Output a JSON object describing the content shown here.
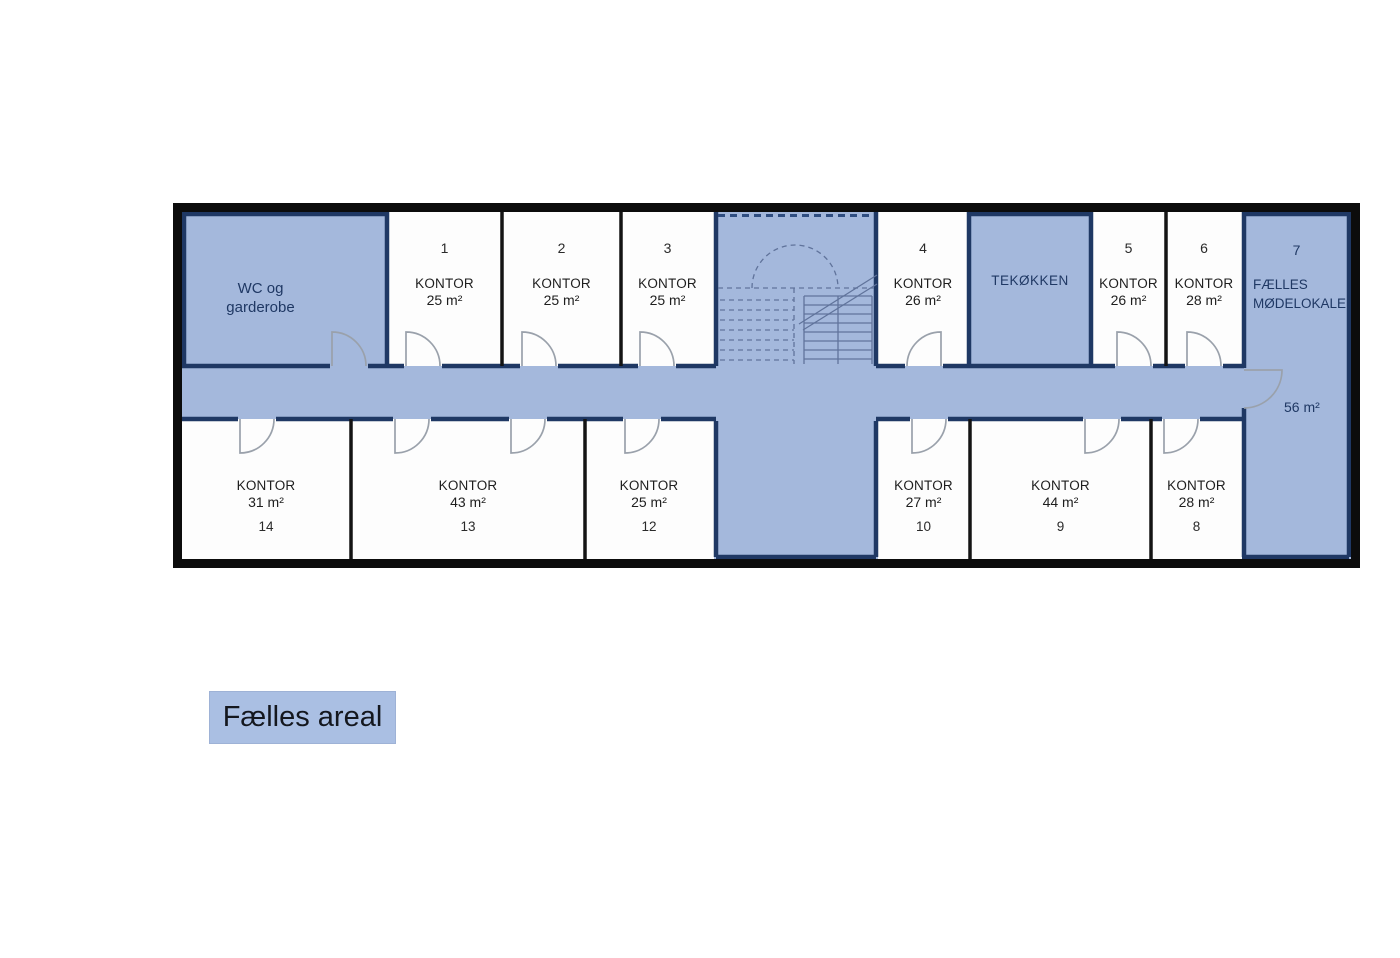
{
  "plan": {
    "rooms": {
      "wc": {
        "line1": "WC og",
        "line2": "garderobe"
      },
      "o1": {
        "num": "1",
        "label": "KONTOR",
        "area": "25 m²"
      },
      "o2": {
        "num": "2",
        "label": "KONTOR",
        "area": "25 m²"
      },
      "o3": {
        "num": "3",
        "label": "KONTOR",
        "area": "25 m²"
      },
      "o4": {
        "num": "4",
        "label": "KONTOR",
        "area": "26 m²"
      },
      "tek": {
        "label": "TEKØKKEN"
      },
      "o5": {
        "num": "5",
        "label": "KONTOR",
        "area": "26 m²"
      },
      "o6": {
        "num": "6",
        "label": "KONTOR",
        "area": "28 m²"
      },
      "meeting": {
        "num": "7",
        "line1": "FÆLLES",
        "line2": "MØDELOKALE",
        "area": "56 m²"
      },
      "o14": {
        "num": "14",
        "label": "KONTOR",
        "area": "31 m²"
      },
      "o13": {
        "num": "13",
        "label": "KONTOR",
        "area": "43 m²"
      },
      "o12": {
        "num": "12",
        "label": "KONTOR",
        "area": "25 m²"
      },
      "o10": {
        "num": "10",
        "label": "KONTOR",
        "area": "27 m²"
      },
      "o9": {
        "num": "9",
        "label": "KONTOR",
        "area": "44 m²"
      },
      "o8": {
        "num": "8",
        "label": "KONTOR",
        "area": "28 m²"
      }
    },
    "legend": {
      "label": "Fælles areal"
    },
    "colors": {
      "common_area": "#a4b8dc",
      "legend_fill": "#aabfe3",
      "wall_navy": "#1f3864",
      "wall_black": "#141414",
      "door_arc": "#9aa1ab",
      "text_dark": "#1e1e1e",
      "text_navy": "#1f3864"
    }
  }
}
